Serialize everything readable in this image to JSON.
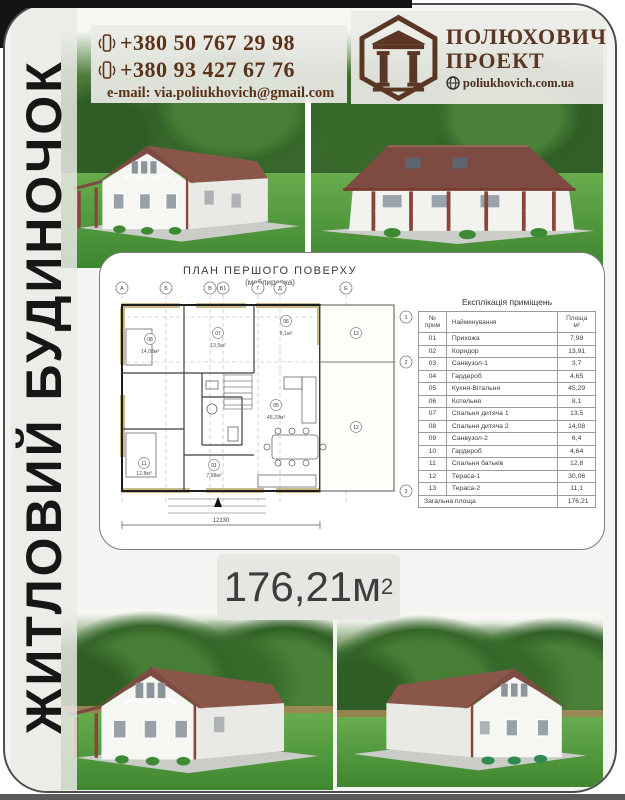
{
  "colors": {
    "accent_brown": "#5b3118",
    "logo_brown": "#5b3624",
    "card_border": "#4e4e4c",
    "roof_brown": "#7d4b41",
    "lawn_green": "#3f8630",
    "badge_gray": "#e6e6e3",
    "sidebar_text": "#161616"
  },
  "sidebar": {
    "title": "ЖИТЛОВИЙ БУДИНОЧОК"
  },
  "header": {
    "phone1": "+380 50 767 29 98",
    "phone2": "+380 93 427 67 76",
    "email": "e-mail: via.poliukhovich@gmail.com",
    "logo_line1": "ПОЛЮХОВИЧ",
    "logo_line2": "ПРОЕКТ",
    "logo_site": "poliukhovich.com.ua"
  },
  "area_badge": {
    "value": "176,21м",
    "sup": "2"
  },
  "plan": {
    "title": "ПЛАН ПЕРШОГО ПОВЕРХУ",
    "subtitle": "(меблировка)",
    "axes_top": [
      "А",
      "Б",
      "В",
      "В1",
      "Г",
      "Д",
      "Е"
    ],
    "axes_side": [
      "1",
      "2",
      "3"
    ],
    "dimension_bottom": "12130",
    "rooms": [
      {
        "num": "08",
        "area": "14,08м²"
      },
      {
        "num": "07",
        "area": "13,5м²"
      },
      {
        "num": "06",
        "area": "8,1м²"
      },
      {
        "num": "05",
        "area": "45,29м²"
      },
      {
        "num": "01",
        "area": "7,98м²"
      },
      {
        "num": "11",
        "area": "12,8м²"
      },
      {
        "num": "12",
        "area": ""
      },
      {
        "num": "13",
        "area": ""
      }
    ],
    "table": {
      "title": "Експлікація приміщень",
      "col_num": "№ прим",
      "col_name": "Найменування",
      "col_area_1": "Площа",
      "col_area_2": "м²",
      "rows": [
        [
          "01",
          "Прихожа",
          "7,98"
        ],
        [
          "02",
          "Коридор",
          "13,91"
        ],
        [
          "03",
          "Санвузол-1",
          "3,7"
        ],
        [
          "04",
          "Гардероб",
          "4,65"
        ],
        [
          "05",
          "Кухня-Вітальня",
          "45,29"
        ],
        [
          "06",
          "Котельня",
          "8,1"
        ],
        [
          "07",
          "Спальня дитяча 1",
          "13,5"
        ],
        [
          "08",
          "Спальня дитяча 2",
          "14,08"
        ],
        [
          "09",
          "Санвузол-2",
          "6,4"
        ],
        [
          "10",
          "Гардероб",
          "4,64"
        ],
        [
          "11",
          "Спальня батьків",
          "12,8"
        ],
        [
          "12",
          "Тераса-1",
          "30,06"
        ],
        [
          "13",
          "Тераса-2",
          "11,1"
        ]
      ],
      "total_label": "Загальна площа",
      "total_value": "176,21"
    }
  }
}
